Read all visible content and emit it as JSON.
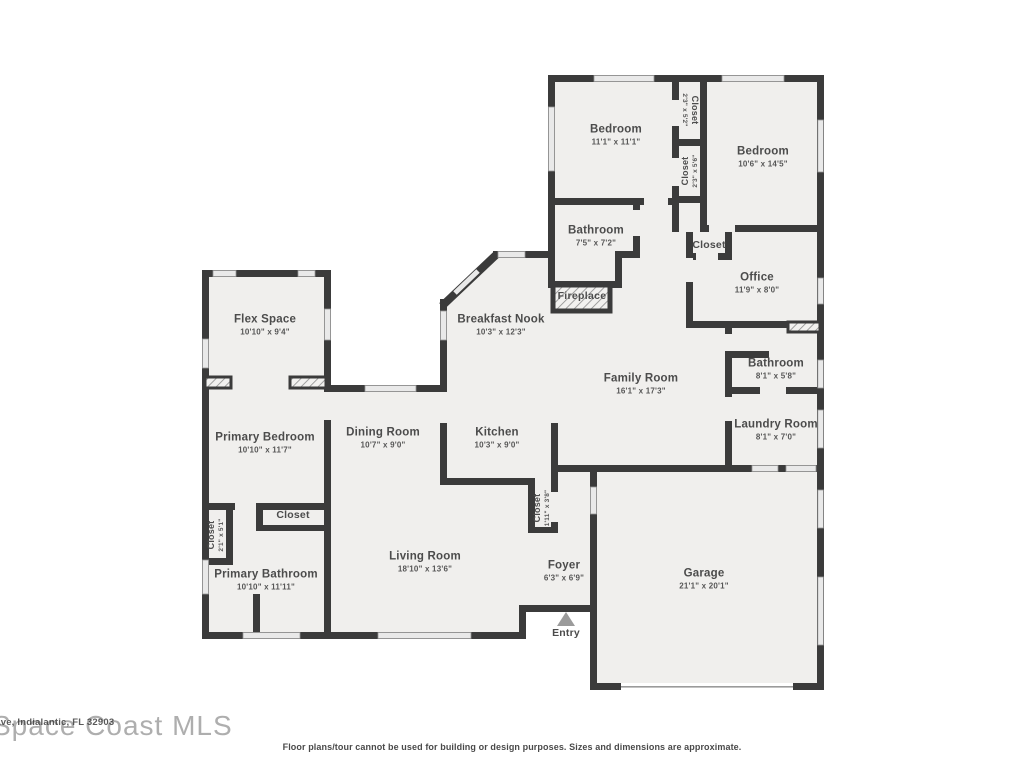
{
  "colors": {
    "wall": "#3b3b3b",
    "floor": "#f0efed",
    "window": "#e9e9e9",
    "label_text": "#4c4c4c",
    "entry_arrow": "#9b9b9b"
  },
  "rooms": [
    {
      "id": "bedroom-1",
      "name": "Bedroom",
      "dims": "11'1\" x 11'1\""
    },
    {
      "id": "closet-bedroom-top",
      "name": "Closet",
      "dims": "2'3\" x 5'2\""
    },
    {
      "id": "closet-bedroom-mid",
      "name": "Closet",
      "dims": "2'3\" x 5'6\""
    },
    {
      "id": "bedroom-2",
      "name": "Bedroom",
      "dims": "10'6\" x 14'5\""
    },
    {
      "id": "bathroom-1",
      "name": "Bathroom",
      "dims": "7'5\" x 7'2\""
    },
    {
      "id": "closet-office",
      "name": "Closet",
      "dims": ""
    },
    {
      "id": "office",
      "name": "Office",
      "dims": "11'9\" x 8'0\""
    },
    {
      "id": "fireplace",
      "name": "Fireplace",
      "dims": ""
    },
    {
      "id": "breakfast-nook",
      "name": "Breakfast Nook",
      "dims": "10'3\" x 12'3\""
    },
    {
      "id": "family-room",
      "name": "Family Room",
      "dims": "16'1\" x 17'3\""
    },
    {
      "id": "bathroom-2",
      "name": "Bathroom",
      "dims": "8'1\" x 5'8\""
    },
    {
      "id": "laundry-room",
      "name": "Laundry Room",
      "dims": "8'1\" x 7'0\""
    },
    {
      "id": "flex-space",
      "name": "Flex Space",
      "dims": "10'10\" x 9'4\""
    },
    {
      "id": "primary-bedroom",
      "name": "Primary Bedroom",
      "dims": "10'10\" x 11'7\""
    },
    {
      "id": "dining-room",
      "name": "Dining Room",
      "dims": "10'7\" x 9'0\""
    },
    {
      "id": "kitchen",
      "name": "Kitchen",
      "dims": "10'3\" x 9'0\""
    },
    {
      "id": "closet-foyer",
      "name": "Closet",
      "dims": "1'11\" x 3'8\""
    },
    {
      "id": "closet-primary-hall",
      "name": "Closet",
      "dims": "2'1\" x 5'1\""
    },
    {
      "id": "closet-primary",
      "name": "Closet",
      "dims": ""
    },
    {
      "id": "primary-bathroom",
      "name": "Primary Bathroom",
      "dims": "10'10\" x 11'11\""
    },
    {
      "id": "living-room",
      "name": "Living Room",
      "dims": "18'10\" x 13'6\""
    },
    {
      "id": "foyer",
      "name": "Foyer",
      "dims": "6'3\" x 6'9\""
    },
    {
      "id": "entry",
      "name": "Entry",
      "dims": ""
    },
    {
      "id": "garage",
      "name": "Garage",
      "dims": "21'1\" x 20'1\""
    }
  ],
  "watermark": {
    "small_text": "Ave, Indialantic, FL 32903",
    "large_text": "Space Coast MLS"
  },
  "footer": {
    "disclaimer": "Floor plans/tour cannot be used for building or design purposes. Sizes and dimensions are approximate."
  }
}
